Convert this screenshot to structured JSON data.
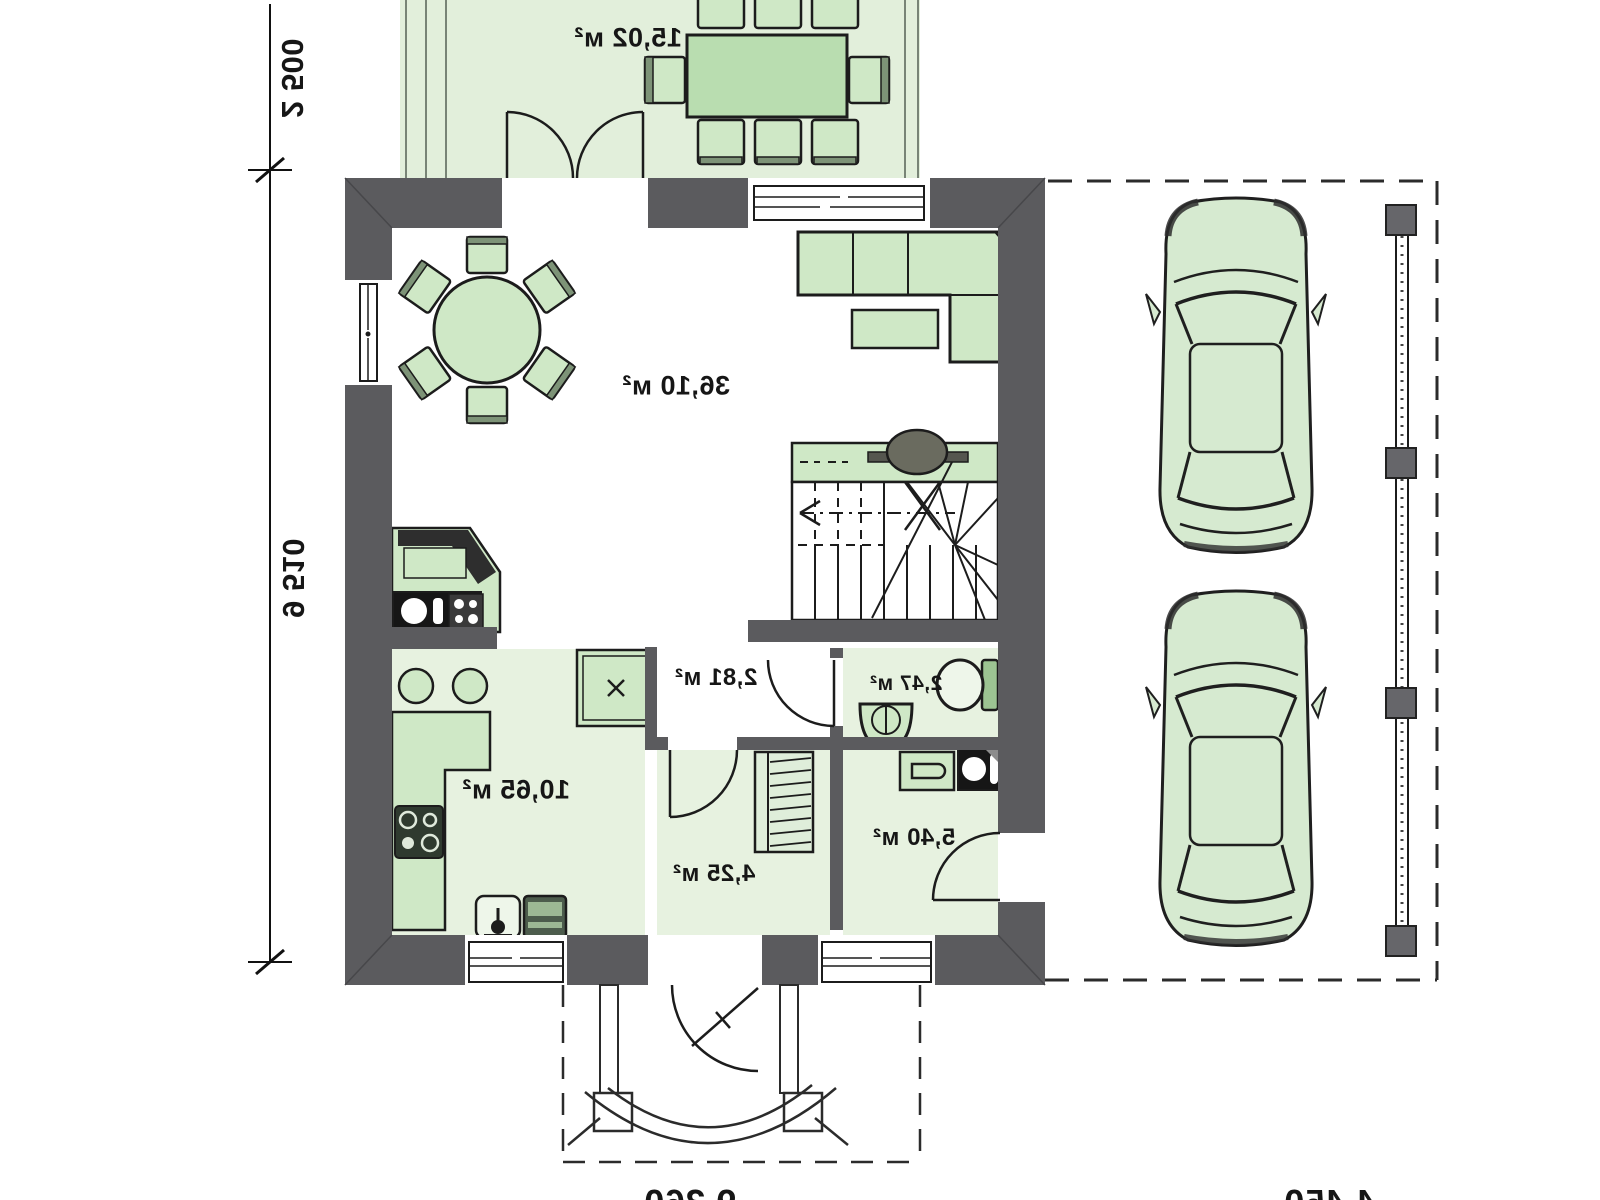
{
  "plan": {
    "kind": "house-ground-floor-plan",
    "rooms": {
      "terrace": {
        "area_label": "15,02 м²"
      },
      "living_dining": {
        "area_label": "36,10 м²"
      },
      "kitchen": {
        "area_label": "10,65 м²"
      },
      "corridor": {
        "area_label": "2,81 м²"
      },
      "wc": {
        "area_label": "2,47 м²"
      },
      "hall": {
        "area_label": "4,25 м²"
      },
      "utility": {
        "area_label": "5,40 м²"
      }
    },
    "dimensions": {
      "left_upper": "2 500",
      "left_lower": "9 510",
      "bottom_center": "9 360",
      "bottom_right": "4 450"
    },
    "colors": {
      "wall": "#5b5b5e",
      "furniture_fill": "#cfe8c6",
      "furniture_dark": "#7d9377",
      "floor_tint": "#e7f2e0",
      "terrace_tint": "#e2efdb",
      "car_fill": "#d6ead0",
      "line": "#1c1c1c"
    }
  }
}
